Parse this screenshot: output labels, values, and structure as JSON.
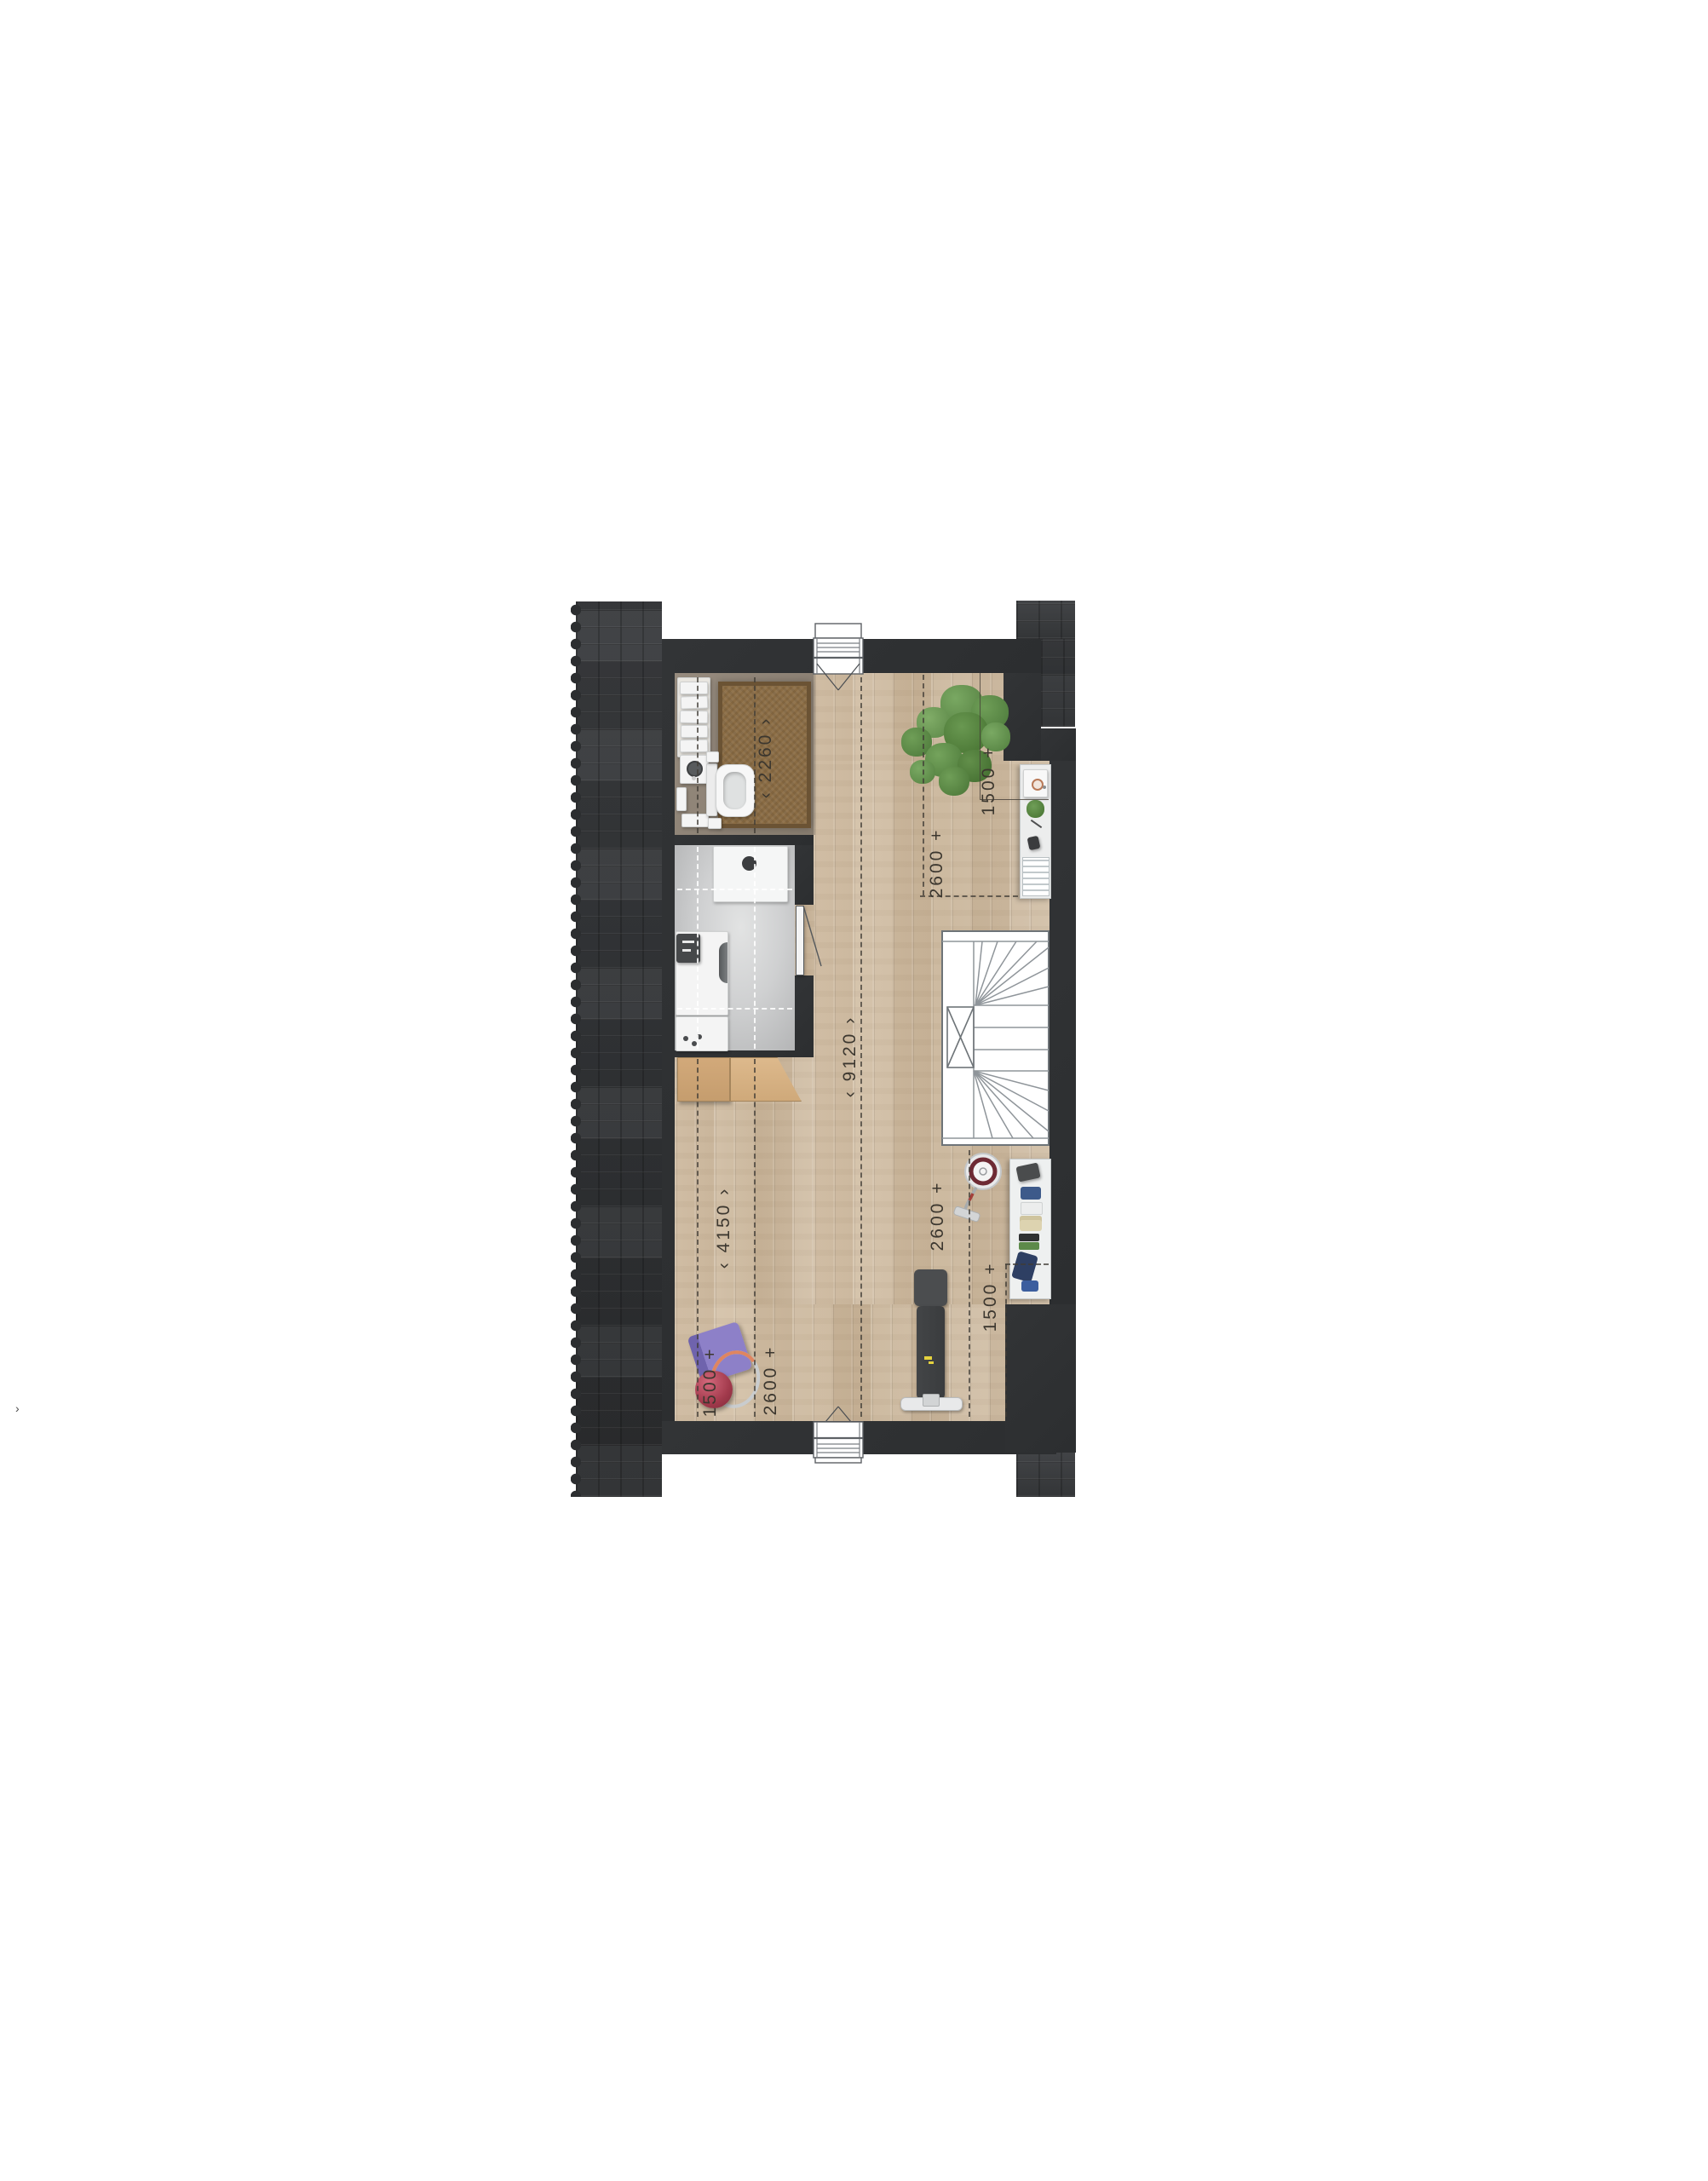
{
  "palette": {
    "wall": "#2f3133",
    "roof_tiles": "#323436",
    "wood_floor": "#cfbca3",
    "laundry_floor": "#cfd0d1",
    "bathroom_floor": "#8f8478",
    "rug": "#8a6c44",
    "plant_green": "#67974f",
    "mat_purple": "#8d80c8",
    "ball_red": "#a23a4c",
    "hoop_orange": "#df8560",
    "vacuum_ring": "#6e2a34",
    "bench_logo_yellow": "#e5d23e",
    "dim_text": "#3c372f"
  },
  "dimensions": {
    "bathroom_2260": "‹  2260  ›",
    "nook_1500": "1500 +",
    "right_upper_2600": "2600 +",
    "length_9120": "‹  9120  ›",
    "width_4150": "‹  4150  ›",
    "right_lower_2600": "2600 +",
    "bottom_right_1500": "1500 +",
    "left_1500": "1500 +",
    "left_2600": "2600 +"
  },
  "stray_glyph": "›",
  "objects": {
    "bathroom": [
      "vanity-towels",
      "washbasin",
      "toilet",
      "rug"
    ],
    "laundry": [
      "table",
      "washing-machine",
      "dryer"
    ],
    "main_room": [
      "roof-window-top",
      "roof-window-bottom",
      "plant",
      "side-desk",
      "stairs",
      "vacuum-cleaner",
      "storage-shelf",
      "workout-bench",
      "barbell",
      "yoga-mat",
      "exercise-ball",
      "hula-hoop",
      "wooden-bench",
      "door"
    ]
  }
}
